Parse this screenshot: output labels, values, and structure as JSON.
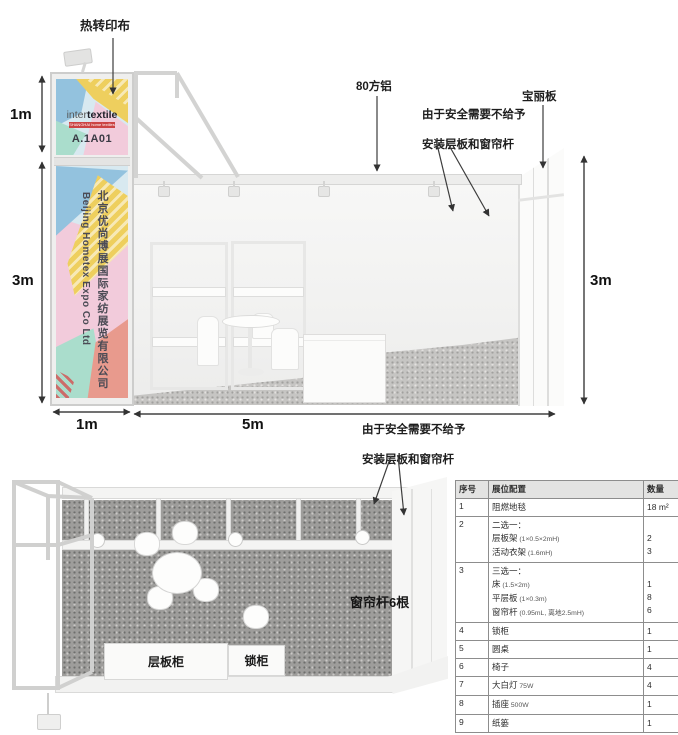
{
  "notes": {
    "safety_line1": "由于安全需要不给予",
    "safety_line2": "安装层板和窗帘杆"
  },
  "front_view": {
    "annotations": {
      "heat_transfer_fabric": "热转印布",
      "aluminum_80": "80方铝",
      "poly_board": "宝丽板"
    },
    "dimensions": {
      "tower_height": "1m",
      "wall_height_left": "3m",
      "tower_width": "1m",
      "booth_width": "5m",
      "wall_height_right": "3m"
    },
    "tower_sign": {
      "logo_inter": "inter",
      "logo_textile": "textile",
      "logo_sub": "SHANGHAI home textiles",
      "booth_no": "A.1A01",
      "company_cn": "北京优尚博展国际家纺展览有限公司",
      "company_en": "Beijing Hometex Expo Co Ltd"
    }
  },
  "plan_view": {
    "curtain_rod_label": "窗帘杆6根",
    "shelf_cabinet_label": "层板柜",
    "lock_cabinet_label": "锁柜"
  },
  "config_table": {
    "headers": [
      "序号",
      "展位配置",
      "数量"
    ],
    "rows": [
      {
        "no": "1",
        "lines": [
          {
            "name": "阻燃地毯",
            "qty": "18 m²"
          }
        ]
      },
      {
        "no": "2",
        "lines": [
          {
            "name": "二选一：",
            "qty": ""
          },
          {
            "name": "层板架",
            "size": "(1×0.5×2mH)",
            "qty": "2"
          },
          {
            "name": "活动衣架",
            "size": "(1.6mH)",
            "qty": "3"
          }
        ]
      },
      {
        "no": "3",
        "lines": [
          {
            "name": "三选一：",
            "qty": ""
          },
          {
            "name": "床",
            "size": "(1.5×2m)",
            "qty": "1"
          },
          {
            "name": "平层板",
            "size": "(1×0.3m)",
            "qty": "8"
          },
          {
            "name": "窗帘杆",
            "size": "(0.95mL, 离地2.5mH)",
            "qty": "6"
          }
        ]
      },
      {
        "no": "4",
        "lines": [
          {
            "name": "锁柜",
            "qty": "1"
          }
        ]
      },
      {
        "no": "5",
        "lines": [
          {
            "name": "圆桌",
            "qty": "1"
          }
        ]
      },
      {
        "no": "6",
        "lines": [
          {
            "name": "椅子",
            "qty": "4"
          }
        ]
      },
      {
        "no": "7",
        "lines": [
          {
            "name": "大白灯",
            "size": "75W",
            "qty": "4"
          }
        ]
      },
      {
        "no": "8",
        "lines": [
          {
            "name": "插座",
            "size": "500W",
            "qty": "1"
          }
        ]
      },
      {
        "no": "9",
        "lines": [
          {
            "name": "纸篓",
            "qty": "1"
          }
        ]
      }
    ]
  },
  "colors": {
    "accent_red": "#cc4444",
    "pastel_yellow": "#eecf5e",
    "pastel_blue": "#93c2de",
    "pastel_pink": "#f2cbdb",
    "pastel_teal": "#aaddcc",
    "pastel_salmon": "#e89a8d",
    "frame": "#cdcdcc",
    "carpet_dark": "#9e9d9b",
    "carpet_light": "#c6c5c3"
  }
}
